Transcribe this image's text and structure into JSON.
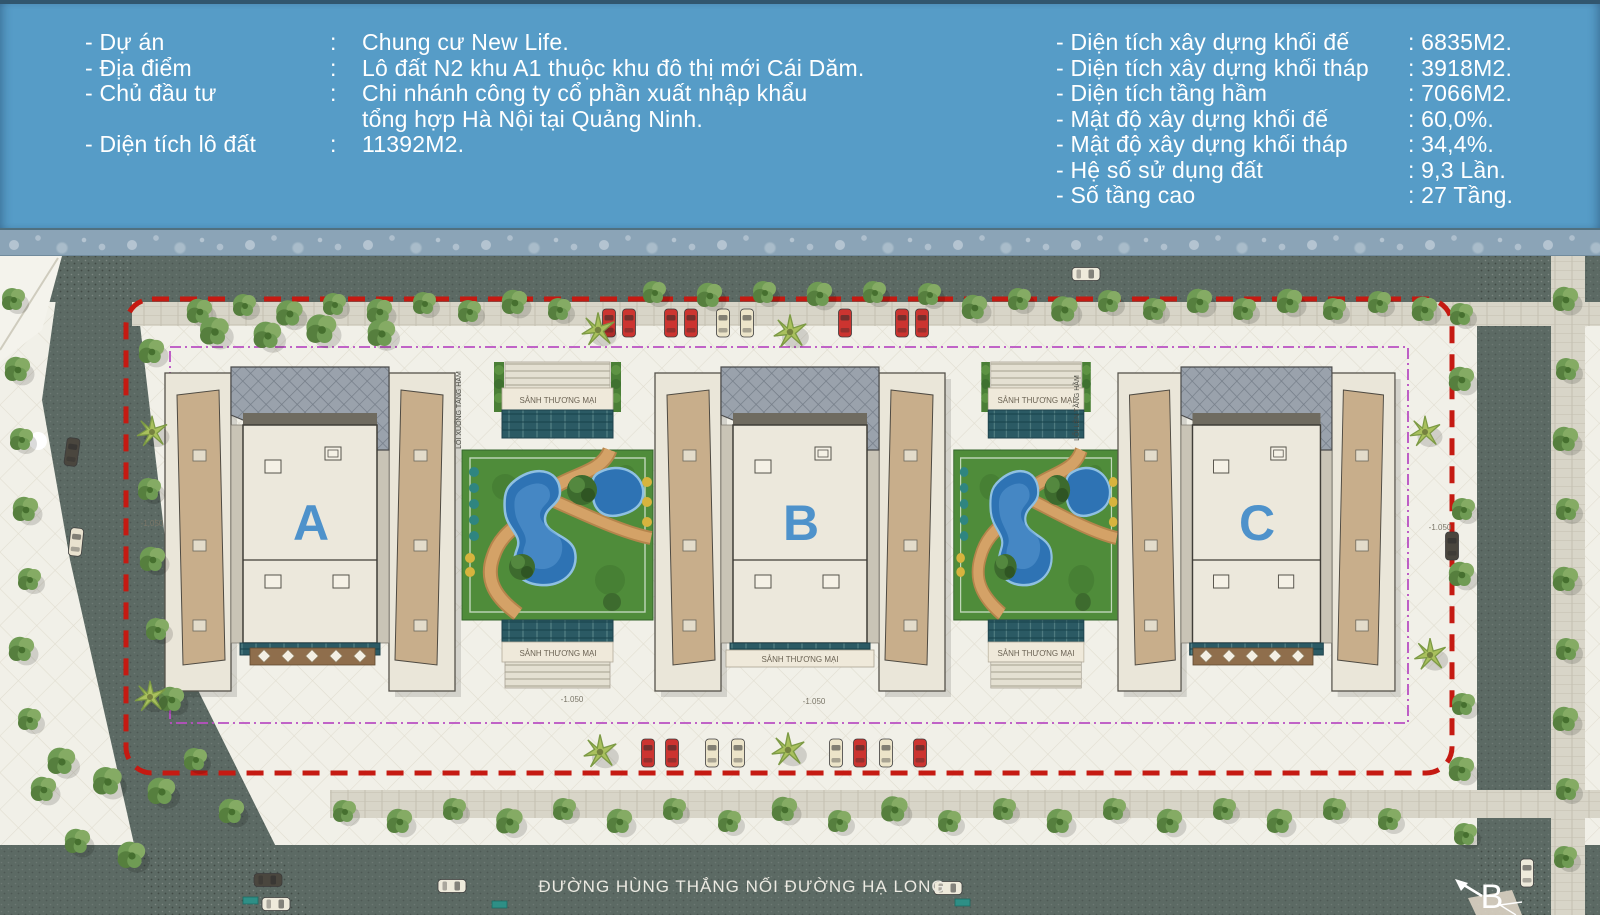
{
  "header": {
    "bg_color": "#569cc7",
    "text_color": "#ffffff",
    "left_rows": [
      {
        "label": "- Dự án",
        "colon": ":",
        "value": "Chung cư New Life."
      },
      {
        "label": "- Địa điểm",
        "colon": ":",
        "value": "Lô đất N2 khu A1 thuộc khu đô thị mới Cái Dăm."
      },
      {
        "label": "- Chủ đầu tư",
        "colon": ":",
        "value": "Chi nhánh công ty cổ phần xuất nhập khẩu",
        "value_line2": "tổng hợp Hà Nội tại Quảng Ninh."
      },
      {
        "label": "- Diện tích lô đất",
        "colon": ":",
        "value": "11392M2."
      }
    ],
    "right_rows": [
      {
        "label": "- Diện tích xây dựng khối đế",
        "value": ": 6835M2."
      },
      {
        "label": "- Diện tích xây dựng khối tháp",
        "value": ": 3918M2."
      },
      {
        "label": "- Diện tích tầng hầm",
        "value": ": 7066M2."
      },
      {
        "label": "- Mật độ xây dựng khối đế",
        "value": ": 60,0%."
      },
      {
        "label": "- Mật độ xây dựng khối tháp",
        "value": ": 34,4%."
      },
      {
        "label": "- Hệ số sử dụng đất",
        "value": ": 9,3 Lần."
      },
      {
        "label": "- Số tầng cao",
        "value": ": 27 Tầng."
      }
    ]
  },
  "plan": {
    "buildings": [
      {
        "label": "A"
      },
      {
        "label": "B"
      },
      {
        "label": "C"
      }
    ],
    "labels": {
      "lobby": "SẢNH THƯƠNG MẠI",
      "street": "ĐƯỜNG HÙNG THẮNG NỐI ĐƯỜNG HẠ LONG",
      "section_marker": "B",
      "elevation": "-1.050",
      "ramp_down": "LỐI XUỐNG TẦNG HẦM",
      "ramp_up": "LỐI LÊN TẦNG HẦM"
    },
    "colors": {
      "letter_blue": "#4e92cb",
      "boundary_red": "#c51a12",
      "setback_magenta": "#b94fc2",
      "pool_blue": "#2e73b4",
      "grass_green": "#4f8c3a",
      "path_tan": "#d4a267",
      "road_gray": "#5c6a64",
      "plaza_cream": "#f1f0e8",
      "roof_tan": "#c8ae8b",
      "building_cream": "#eae6d9"
    }
  }
}
